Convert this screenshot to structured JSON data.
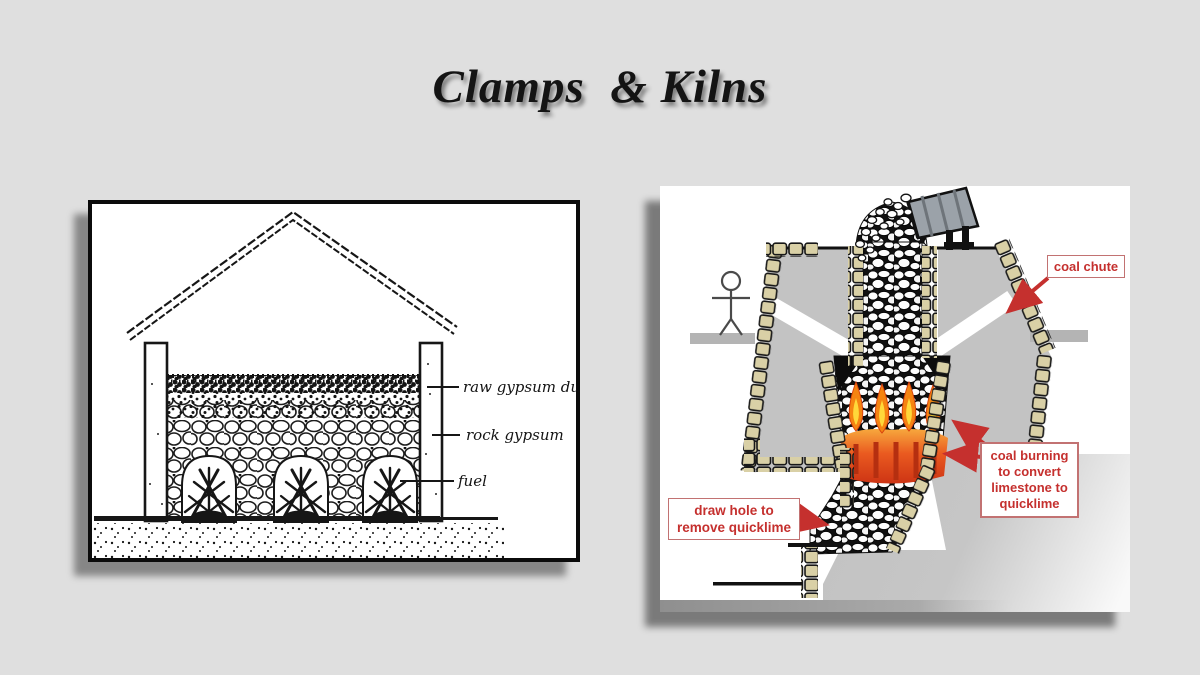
{
  "slide": {
    "title": "Clamps  & Kilns",
    "background_color": "#dfdfdf"
  },
  "clamp_figure": {
    "labels": {
      "raw_gypsum_dust": "raw gypsum dust",
      "rock_gypsum": "rock gypsum",
      "fuel": "fuel"
    },
    "ink_color": "#161616"
  },
  "kiln_figure": {
    "labels": {
      "coal_chute": "coal chute",
      "coal_burning": [
        "coal burning",
        "to convert",
        "limestone to",
        "quicklime"
      ],
      "draw_hole": [
        "draw hole to",
        "remove quicklime"
      ]
    },
    "colors": {
      "label_red": "#c5302e",
      "earth_gray": "#c3c3c3",
      "stone_tan": "#d9d0a6",
      "flame_orange": "#f58411",
      "flame_yellow": "#ffd83a",
      "glow_red": "#d8341c"
    }
  }
}
